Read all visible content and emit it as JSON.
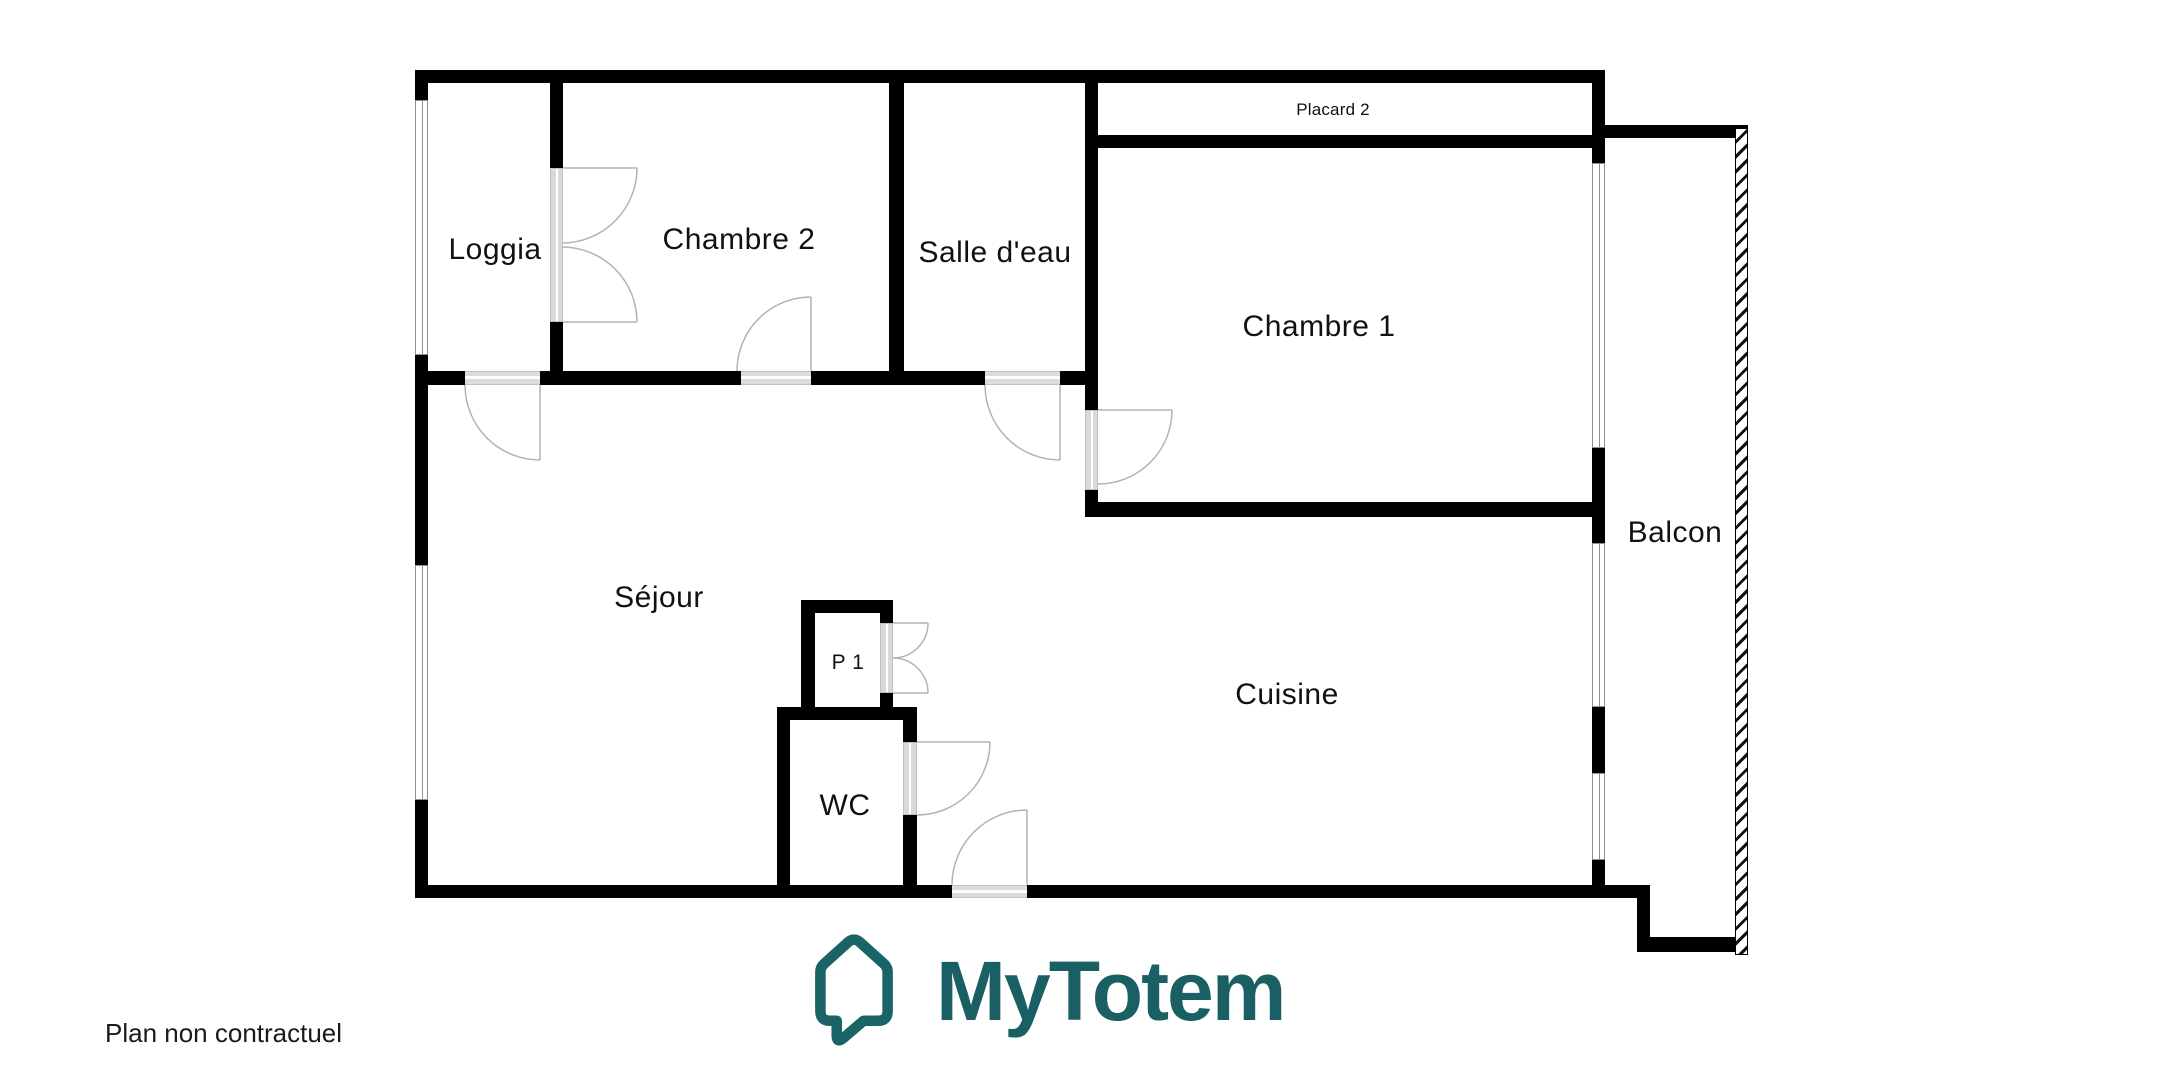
{
  "plan": {
    "rooms": [
      {
        "id": "loggia",
        "label": "Loggia"
      },
      {
        "id": "chambre2",
        "label": "Chambre 2"
      },
      {
        "id": "salle-deau",
        "label": "Salle d'eau"
      },
      {
        "id": "placard2",
        "label": "Placard 2"
      },
      {
        "id": "chambre1",
        "label": "Chambre 1"
      },
      {
        "id": "balcon",
        "label": "Balcon"
      },
      {
        "id": "sejour",
        "label": "Séjour"
      },
      {
        "id": "p1",
        "label": "P 1"
      },
      {
        "id": "wc",
        "label": "WC"
      },
      {
        "id": "cuisine",
        "label": "Cuisine"
      }
    ],
    "disclaimer": "Plan non contractuel"
  },
  "logo": {
    "wordmark": "MyTotem",
    "icon": "house-speech-bubble-icon",
    "color": "#1A5F63"
  },
  "colors": {
    "wall": "#000000",
    "door_arc": "#b3b3b3",
    "window_frame": "#8f8f8f",
    "opening_fill": "#dcdcdc",
    "brand_teal": "#1A5F63",
    "text": "#1a1a1a"
  }
}
